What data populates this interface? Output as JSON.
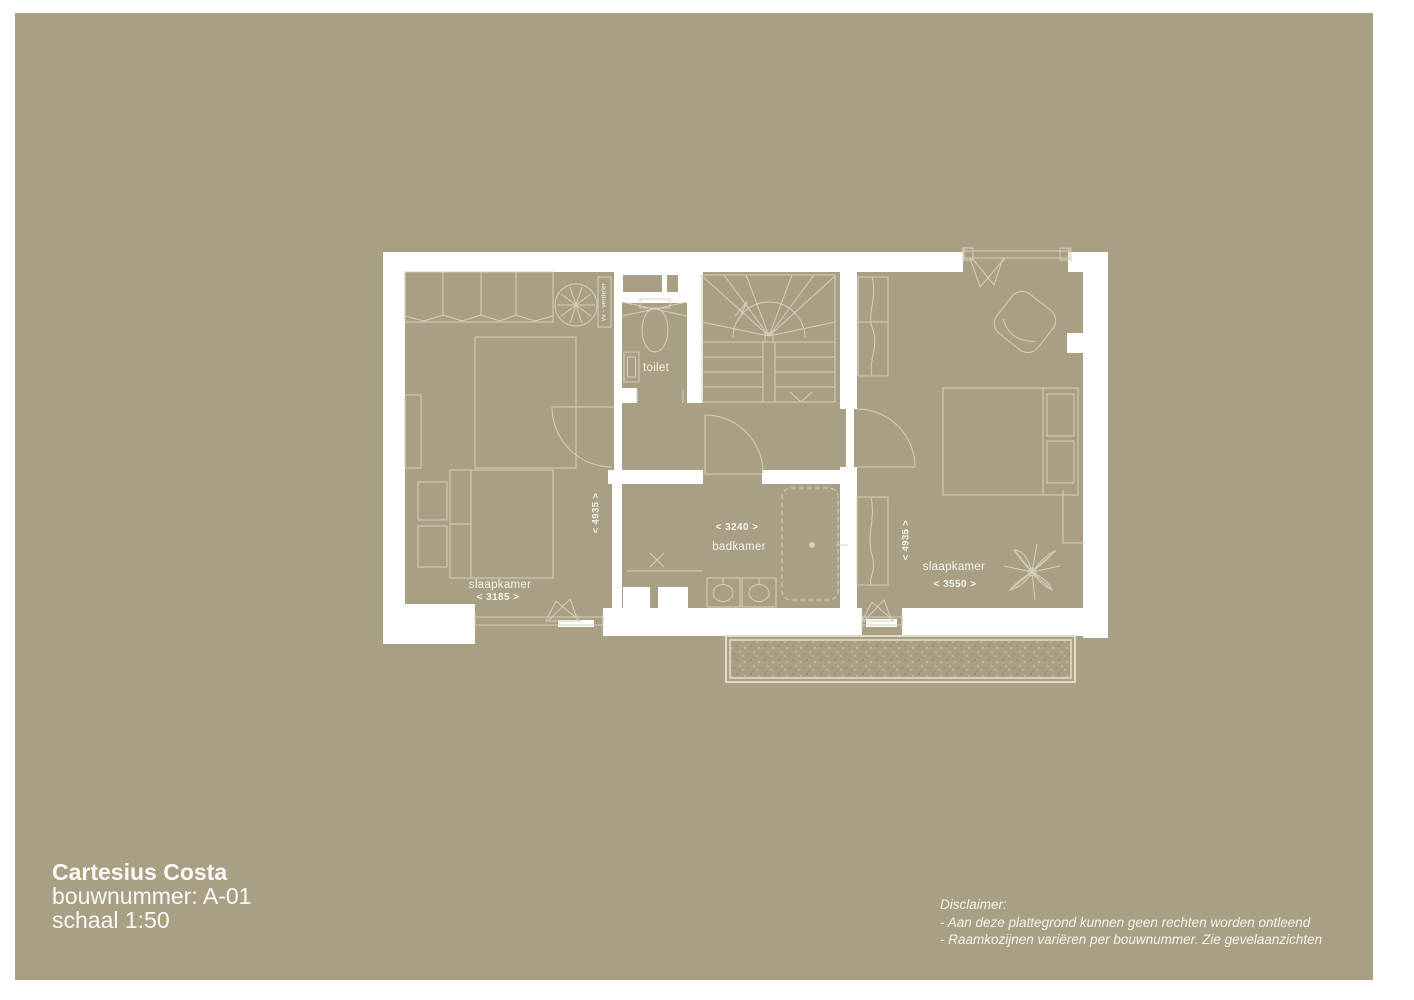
{
  "colors": {
    "background": "#a89f84",
    "wall": "#ffffff",
    "line": "#d6cfbb",
    "text": "#f6f4ec"
  },
  "title_block": {
    "project": "Cartesius Costa",
    "bouwnummer": "bouwnummer: A-01",
    "schaal": "schaal 1:50"
  },
  "disclaimer": {
    "heading": "Disclaimer:",
    "line1": "- Aan deze plattegrond kunnen geen rechten worden ontleend",
    "line2": "- Raamkozijnen variëren per bouwnummer. Zie gevelaanzichten"
  },
  "plan": {
    "rooms": {
      "bedroom_left": {
        "label": "slaapkamer",
        "width_dim": "< 3185 >",
        "depth_dim": "< 4935 >"
      },
      "toilet": {
        "label": "toilet"
      },
      "bathroom": {
        "label": "badkamer",
        "width_dim": "< 3240 >"
      },
      "bedroom_right": {
        "label": "slaapkamer",
        "width_dim": "< 3550 >",
        "depth_dim": "< 4935 >"
      }
    },
    "annotations": {
      "vv_verdeler": "vv - verdeler"
    }
  }
}
